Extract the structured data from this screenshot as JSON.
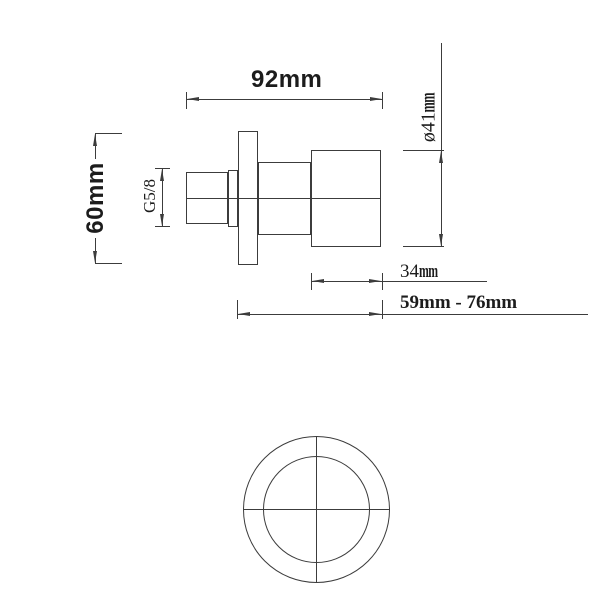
{
  "theme": {
    "background": "#ffffff",
    "line_color": "#3c3c3c",
    "text_color": "#1c1c1c"
  },
  "drawing": {
    "type": "technical-dimension-drawing",
    "views": [
      "side-elevation",
      "front-face"
    ],
    "dimensions": {
      "total_width": {
        "label": "92mm"
      },
      "plate_height": {
        "label": "60mm"
      },
      "thread_size": {
        "label": "G5/8"
      },
      "handle_diameter": {
        "value": "ø41",
        "unit": "mm"
      },
      "handle_depth": {
        "value": "34",
        "unit": "mm"
      },
      "projection_range": {
        "label": "59mm - 76mm"
      }
    }
  }
}
